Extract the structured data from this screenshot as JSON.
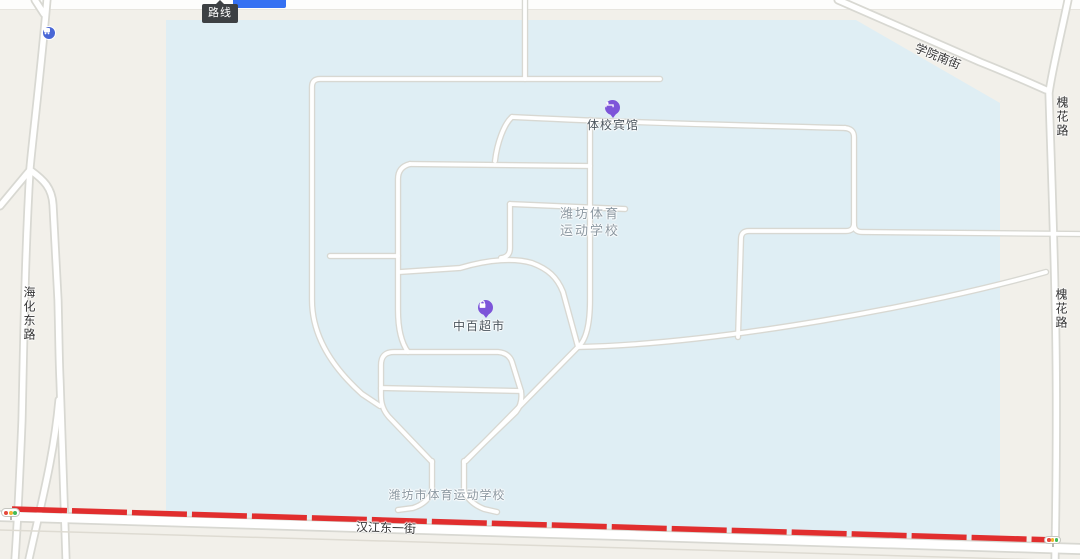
{
  "toolbar": {
    "route_tooltip": "路线"
  },
  "map": {
    "poi": {
      "hotel": {
        "label": "体校宾馆",
        "icon": "bed-icon"
      },
      "supermarket": {
        "label": "中百超市",
        "icon": "shopping-bag-icon"
      },
      "bus_stop": {
        "icon": "bus-icon"
      }
    },
    "campus": {
      "name_line1": "潍坊体育",
      "name_line2": "运动学校",
      "gate_label": "潍坊市体育运动学校"
    },
    "roads": {
      "bottom_street": "汉江东一街",
      "left_road": "海化东路",
      "right_road": "槐花路",
      "topright_road": "学院南街"
    },
    "traffic": {
      "signal_icon": "traffic-light-icon",
      "congestion_color_meaning": "heavy"
    },
    "colors": {
      "land": "#f2f0ea",
      "campus_fill": "#dfeef4",
      "road_fill": "#ffffff",
      "road_casing": "#d8d8d2",
      "traffic_heavy": "#e12e2e",
      "poi_icon": "#7d55d9",
      "bus_icon": "#4a67d6",
      "accent_button": "#3470f2",
      "label_dark": "#333333",
      "label_poi": "#4a545c",
      "label_area": "#8c98a1"
    }
  }
}
